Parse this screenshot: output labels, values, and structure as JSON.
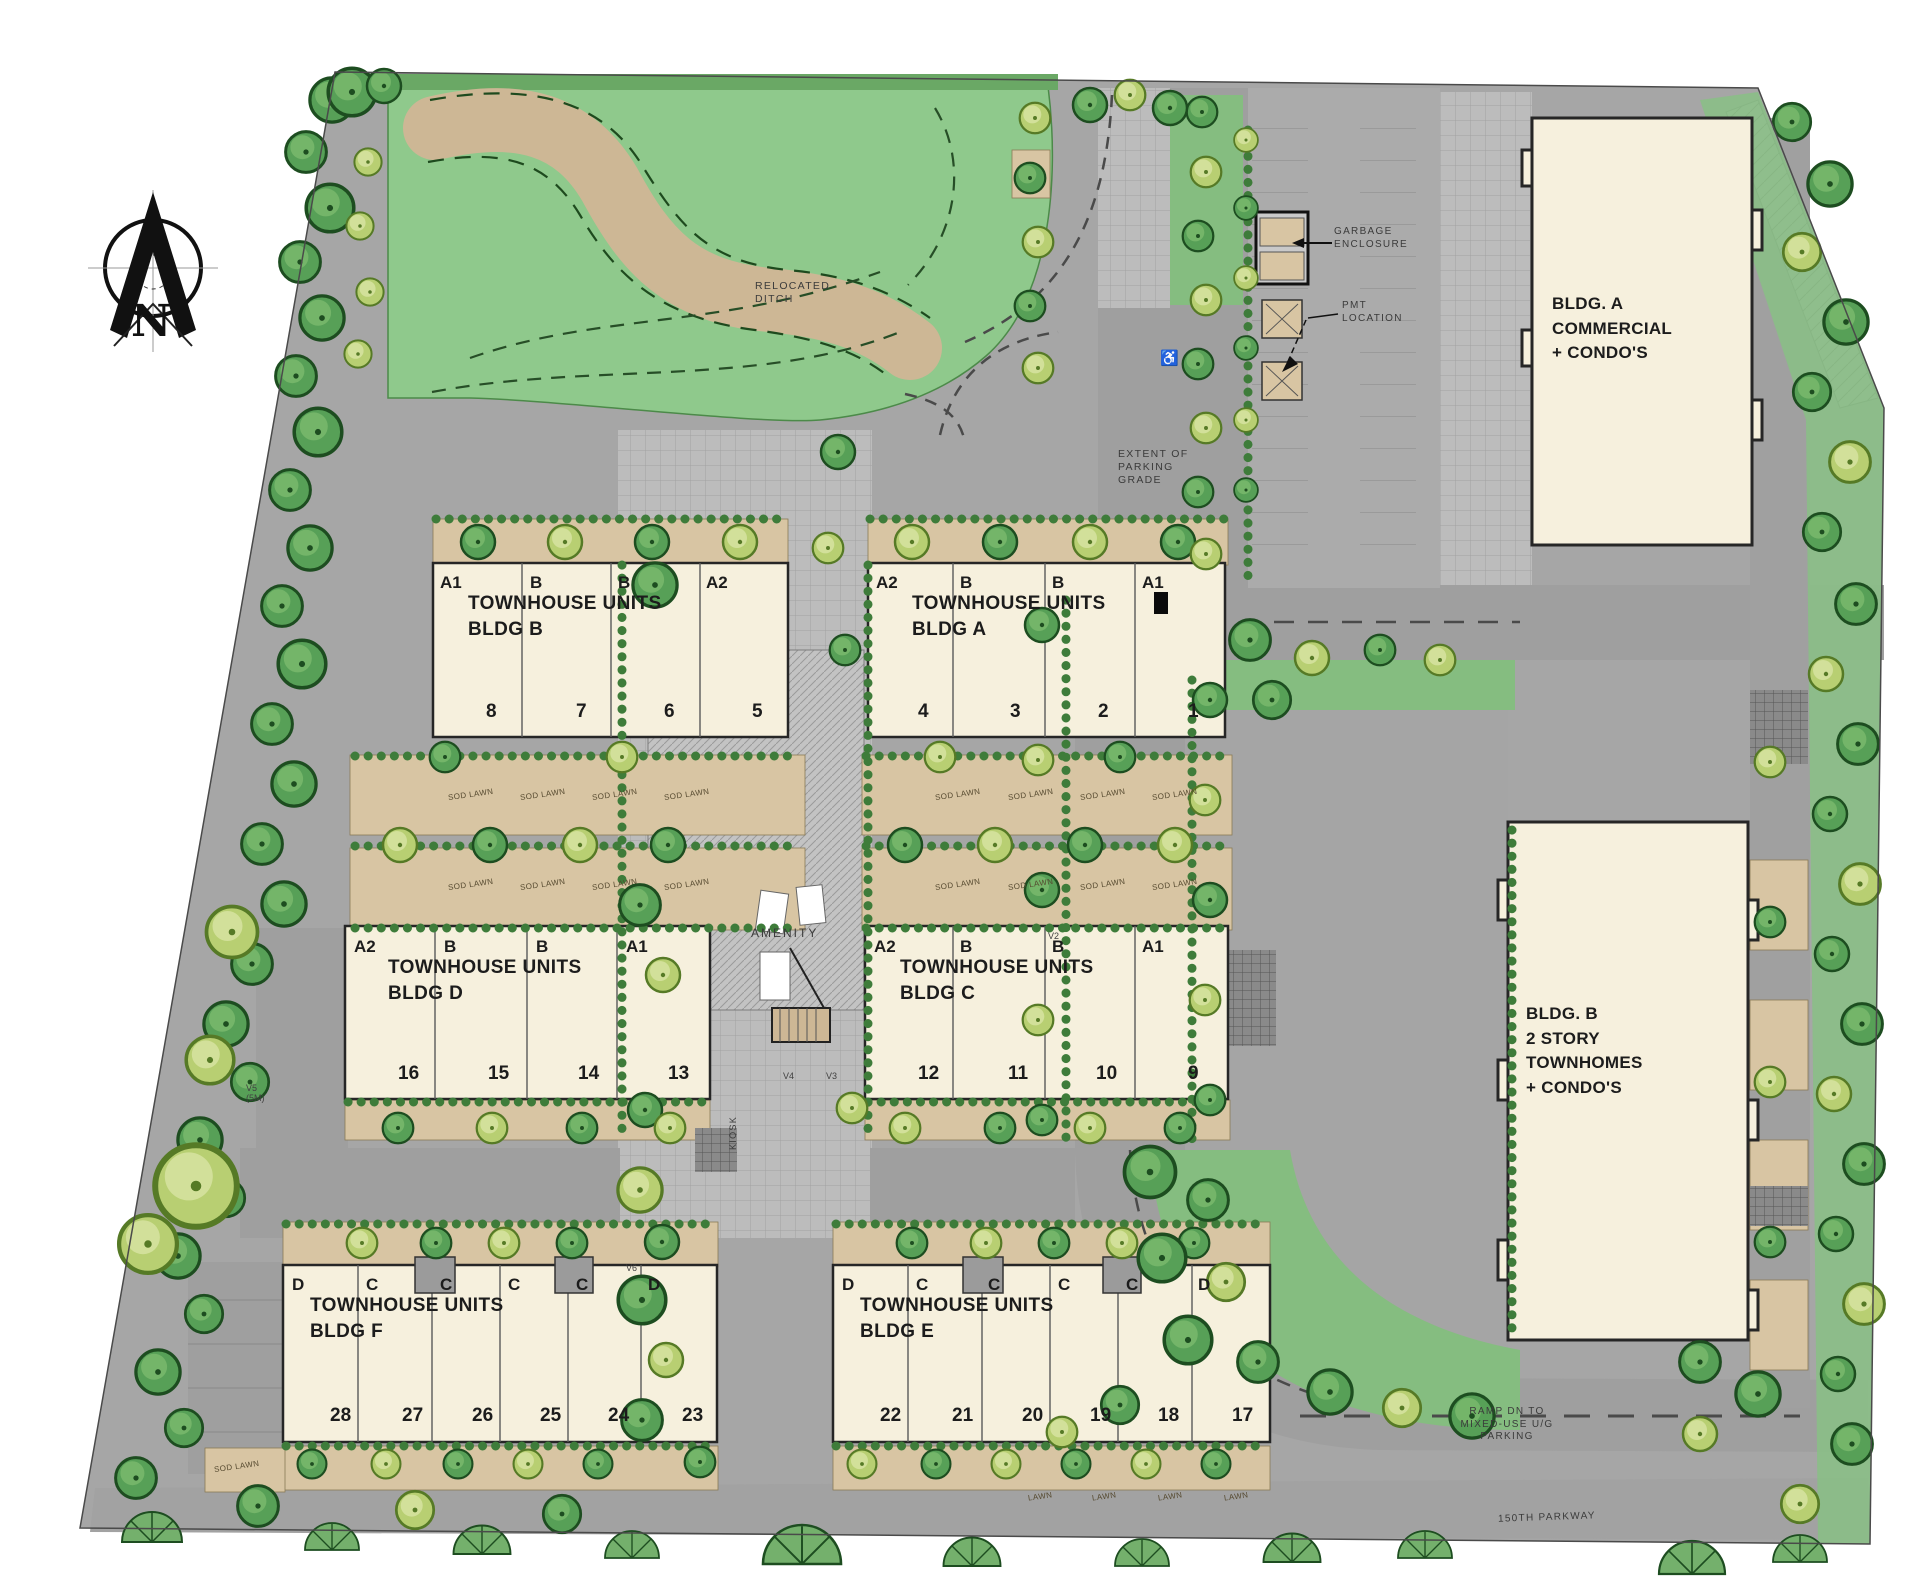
{
  "plan": {
    "north": "N",
    "labels": {
      "relocated_ditch": "RELOCATED\nDITCH",
      "garbage_enclosure": "GARBAGE\nENCLOSURE",
      "pmt_location": "PMT\nLOCATION",
      "extent_grade": "EXTENT OF\nPARKING\nGRADE",
      "amenity": "AMENITY",
      "kiosk": "KIOSK",
      "ramp": "RAMP DN TO\nMIXED-USE U/G\nPARKING",
      "street": "150TH PARKWAY",
      "sod_lawn": "SOD LAWN",
      "lawn": "LAWN",
      "handicap": "♿",
      "v2": "V2",
      "v3": "V3",
      "v4": "V4",
      "v5": "V5\n(5M)",
      "v6": "V6"
    },
    "buildings": {
      "commercial": "BLDG. A\nCOMMERCIAL\n+ CONDO'S",
      "condos": "BLDG. B\n2 STORY\nTOWNHOMES\n+ CONDO'S",
      "rows": [
        {
          "title": "TOWNHOUSE UNITS",
          "subtitle": "BLDG B",
          "types": [
            "A1",
            "B",
            "B",
            "A2"
          ],
          "numbers": [
            "8",
            "7",
            "6",
            "5"
          ]
        },
        {
          "title": "TOWNHOUSE UNITS",
          "subtitle": "BLDG A",
          "types": [
            "A2",
            "B",
            "B",
            "A1"
          ],
          "numbers": [
            "4",
            "3",
            "2",
            "1"
          ]
        },
        {
          "title": "TOWNHOUSE UNITS",
          "subtitle": "BLDG D",
          "types": [
            "A2",
            "B",
            "B",
            "A1"
          ],
          "numbers": [
            "16",
            "15",
            "14",
            "13"
          ]
        },
        {
          "title": "TOWNHOUSE UNITS",
          "subtitle": "BLDG C",
          "types": [
            "A2",
            "B",
            "B",
            "A1"
          ],
          "numbers": [
            "12",
            "11",
            "10",
            "9"
          ]
        },
        {
          "title": "TOWNHOUSE UNITS",
          "subtitle": "BLDG F",
          "types": [
            "D",
            "C",
            "C",
            "C",
            "C",
            "D"
          ],
          "numbers": [
            "28",
            "27",
            "26",
            "25",
            "24",
            "23"
          ]
        },
        {
          "title": "TOWNHOUSE UNITS",
          "subtitle": "BLDG E",
          "types": [
            "D",
            "C",
            "C",
            "C",
            "C",
            "D"
          ],
          "numbers": [
            "22",
            "21",
            "20",
            "19",
            "18",
            "17"
          ]
        }
      ]
    },
    "colors": {
      "lawn": "#8fc98c",
      "tree": "#57a057",
      "road": "#9f9f9f",
      "building": "#f6f0dd",
      "ditch": "#cdb795",
      "sod": "#d8c5a3"
    }
  }
}
